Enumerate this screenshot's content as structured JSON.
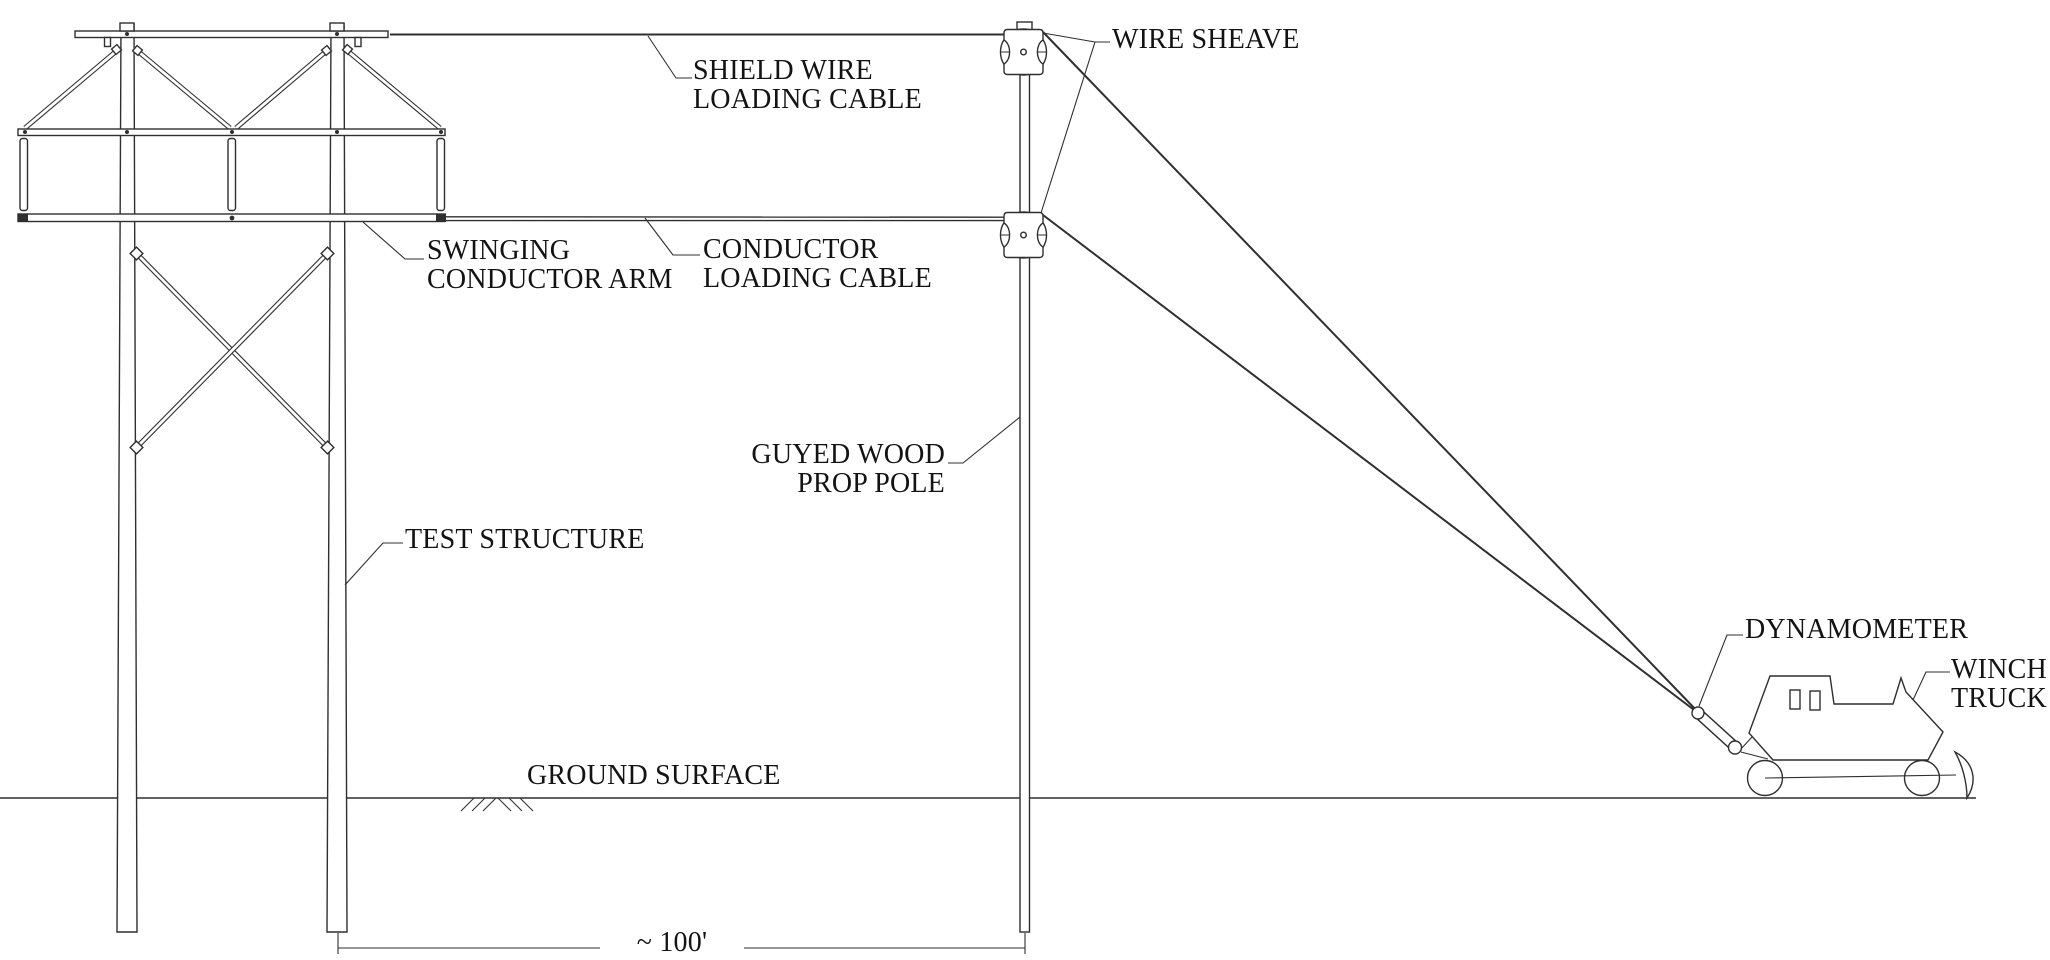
{
  "title": "Transmission line test structure loading arrangement diagram",
  "colors": {
    "line": "#2f2f2f",
    "text": "#131313",
    "bg": "#ffffff"
  },
  "labels": {
    "wire_sheave": {
      "text": "WIRE SHEAVE"
    },
    "shield_wire": {
      "line1": "SHIELD WIRE",
      "line2": "LOADING CABLE"
    },
    "swinging_arm": {
      "line1": "SWINGING",
      "line2": "CONDUCTOR ARM"
    },
    "conductor_cable": {
      "line1": "CONDUCTOR",
      "line2": "LOADING CABLE"
    },
    "guyed_pole": {
      "line1": "GUYED WOOD",
      "line2": "PROP POLE"
    },
    "test_structure": {
      "text": "TEST STRUCTURE"
    },
    "ground_surface": {
      "text": "GROUND SURFACE"
    },
    "dynamometer": {
      "text": "DYNAMOMETER"
    },
    "winch_truck": {
      "line1": "WINCH",
      "line2": "TRUCK"
    },
    "dimension_span": {
      "text": "~ 100'"
    }
  }
}
